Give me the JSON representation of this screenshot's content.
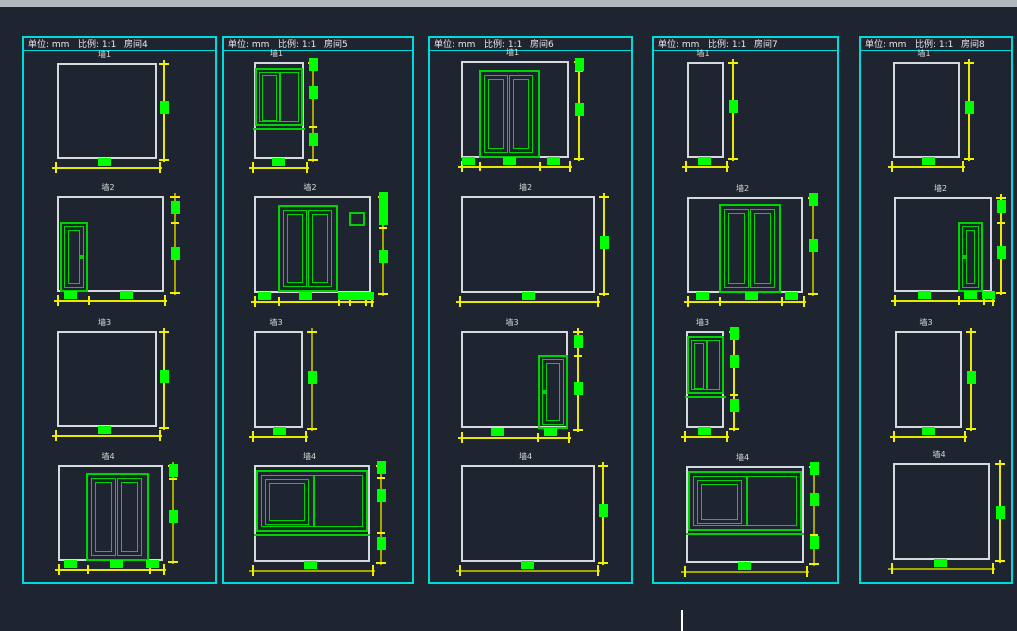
{
  "theme": {
    "background": "#1f2530",
    "titlebar_edge": "#b4b9c0",
    "panel_border": "#00dcdc",
    "wall_outline": "#d6dade",
    "feature_green": "#00d400",
    "dim_block_green": "#00ff00",
    "dim_bright": "#e9e900",
    "dim_dark": "#a6a600",
    "tick_yellow": "#f2f200",
    "text": "#e8e8e8",
    "cursor": "#ffffff"
  },
  "cursor": {
    "x": 681,
    "y": 610,
    "w": 2,
    "h": 21
  },
  "panels": [
    {
      "box": {
        "x": 22,
        "y": 36,
        "w": 195,
        "h": 548
      },
      "header": {
        "unit_label": "单位: mm",
        "scale_label": "比例: 1:1",
        "room_label": "房间4"
      },
      "walls": [
        {
          "label": "墙1",
          "rect": {
            "x": 57,
            "y": 63,
            "w": 100,
            "h": 96
          },
          "features": [],
          "vdim": {
            "x": 163,
            "y1": 63,
            "y2": 159,
            "ticks": [
              63,
              159
            ],
            "blocks": [
              107
            ],
            "tone": "b"
          },
          "hdim": {
            "y": 167,
            "x1": 55,
            "x2": 159,
            "ticks": [
              55,
              159
            ],
            "blocks": [
              104
            ],
            "tone": "b"
          }
        },
        {
          "label": "墙2",
          "rect": {
            "x": 57,
            "y": 196,
            "w": 107,
            "h": 96
          },
          "features": [
            {
              "type": "door",
              "x": 60,
              "y": 222,
              "w": 28,
              "h": 70,
              "handle": "right"
            }
          ],
          "vdim": {
            "x": 174,
            "y1": 196,
            "y2": 292,
            "ticks": [
              196,
              222,
              292
            ],
            "blocks": [
              207,
              253
            ],
            "tone": "d"
          },
          "hdim": {
            "y": 300,
            "x1": 57,
            "x2": 164,
            "ticks": [
              57,
              88,
              164
            ],
            "blocks": [
              70,
              126
            ],
            "tone": "b"
          }
        },
        {
          "label": "墙3",
          "rect": {
            "x": 57,
            "y": 331,
            "w": 100,
            "h": 96
          },
          "features": [],
          "vdim": {
            "x": 163,
            "y1": 331,
            "y2": 427,
            "ticks": [
              331,
              427
            ],
            "blocks": [
              376
            ],
            "tone": "b"
          },
          "hdim": {
            "y": 435,
            "x1": 55,
            "x2": 159,
            "ticks": [
              55,
              159
            ],
            "blocks": [
              104
            ],
            "tone": "b"
          }
        },
        {
          "label": "墙4",
          "rect": {
            "x": 58,
            "y": 465,
            "w": 105,
            "h": 96
          },
          "features": [
            {
              "type": "ddoor",
              "x": 86,
              "y": 473,
              "w": 63,
              "h": 88
            }
          ],
          "vdim": {
            "x": 172,
            "y1": 465,
            "y2": 561,
            "ticks": [
              465,
              478,
              561
            ],
            "blocks": [
              470,
              516
            ],
            "tone": "d"
          },
          "hdim": {
            "y": 569,
            "x1": 58,
            "x2": 163,
            "ticks": [
              58,
              87,
              149,
              163
            ],
            "blocks": [
              70,
              116,
              152
            ],
            "tone": "b"
          }
        }
      ]
    },
    {
      "box": {
        "x": 222,
        "y": 36,
        "w": 192,
        "h": 548
      },
      "header": {
        "unit_label": "单位: mm",
        "scale_label": "比例: 1:1",
        "room_label": "房间5"
      },
      "walls": [
        {
          "label": "墙1",
          "rect": {
            "x": 254,
            "y": 62,
            "w": 50,
            "h": 97
          },
          "features": [
            {
              "type": "window2",
              "x": 255,
              "y": 68,
              "w": 48,
              "h": 58
            }
          ],
          "vdim": {
            "x": 312,
            "y1": 62,
            "y2": 159,
            "ticks": [
              62,
              126,
              159
            ],
            "blocks": [
              64,
              92,
              139
            ],
            "tone": "d"
          },
          "hdim": {
            "y": 167,
            "x1": 252,
            "x2": 306,
            "ticks": [
              252,
              306
            ],
            "blocks": [
              278
            ],
            "tone": "b"
          }
        },
        {
          "label": "墙2",
          "rect": {
            "x": 254,
            "y": 196,
            "w": 117,
            "h": 97
          },
          "features": [
            {
              "type": "ddoor",
              "x": 278,
              "y": 205,
              "w": 60,
              "h": 87
            },
            {
              "type": "swin",
              "x": 349,
              "y": 212,
              "w": 16,
              "h": 14
            }
          ],
          "vdim": {
            "x": 382,
            "y1": 196,
            "y2": 293,
            "ticks": [
              196,
              211,
              227,
              293
            ],
            "blocks": [
              198,
              207,
              218,
              256
            ],
            "tone": "d"
          },
          "hdim": {
            "y": 301,
            "x1": 254,
            "x2": 371,
            "ticks": [
              254,
              278,
              338,
              349,
              365,
              371
            ],
            "blocks": [
              264,
              305,
              344,
              356,
              367
            ],
            "tone": "b"
          }
        },
        {
          "label": "墙3",
          "rect": {
            "x": 254,
            "y": 331,
            "w": 49,
            "h": 97
          },
          "features": [],
          "vdim": {
            "x": 311,
            "y1": 331,
            "y2": 428,
            "ticks": [
              331,
              428
            ],
            "blocks": [
              377
            ],
            "tone": "d"
          },
          "hdim": {
            "y": 436,
            "x1": 252,
            "x2": 305,
            "ticks": [
              252,
              305
            ],
            "blocks": [
              279
            ],
            "tone": "b"
          }
        },
        {
          "label": "墙4",
          "rect": {
            "x": 254,
            "y": 465,
            "w": 116,
            "h": 97
          },
          "features": [
            {
              "type": "windowW",
              "x": 256,
              "y": 470,
              "w": 112,
              "h": 62
            }
          ],
          "vdim": {
            "x": 380,
            "y1": 465,
            "y2": 562,
            "ticks": [
              465,
              477,
              532,
              562
            ],
            "blocks": [
              467,
              495,
              543
            ],
            "tone": "d"
          },
          "hdim": {
            "y": 570,
            "x1": 252,
            "x2": 372,
            "ticks": [
              252,
              372
            ],
            "blocks": [
              310
            ],
            "tone": "d"
          }
        }
      ]
    },
    {
      "box": {
        "x": 428,
        "y": 36,
        "w": 205,
        "h": 548
      },
      "header": {
        "unit_label": "单位: mm",
        "scale_label": "比例: 1:1",
        "room_label": "房间6"
      },
      "walls": [
        {
          "label": "墙1",
          "rect": {
            "x": 461,
            "y": 61,
            "w": 108,
            "h": 97
          },
          "features": [
            {
              "type": "ddoor",
              "x": 479,
              "y": 70,
              "w": 61,
              "h": 88
            }
          ],
          "vdim": {
            "x": 578,
            "y1": 61,
            "y2": 158,
            "ticks": [
              61,
              70,
              158
            ],
            "blocks": [
              64,
              109
            ],
            "tone": "b"
          },
          "hdim": {
            "y": 166,
            "x1": 461,
            "x2": 569,
            "ticks": [
              461,
              479,
              539,
              569
            ],
            "blocks": [
              468,
              509,
              553
            ],
            "tone": "b"
          }
        },
        {
          "label": "墙2",
          "rect": {
            "x": 461,
            "y": 196,
            "w": 134,
            "h": 97
          },
          "features": [],
          "vdim": {
            "x": 603,
            "y1": 196,
            "y2": 293,
            "ticks": [
              196,
              293
            ],
            "blocks": [
              242
            ],
            "tone": "b"
          },
          "hdim": {
            "y": 301,
            "x1": 459,
            "x2": 597,
            "ticks": [
              459,
              597
            ],
            "blocks": [
              528
            ],
            "tone": "b"
          }
        },
        {
          "label": "墙3",
          "rect": {
            "x": 461,
            "y": 331,
            "w": 107,
            "h": 97
          },
          "features": [
            {
              "type": "door",
              "x": 538,
              "y": 355,
              "w": 30,
              "h": 74,
              "handle": "left"
            }
          ],
          "vdim": {
            "x": 577,
            "y1": 331,
            "y2": 429,
            "ticks": [
              331,
              355,
              429
            ],
            "blocks": [
              341,
              388
            ],
            "tone": "b"
          },
          "hdim": {
            "y": 437,
            "x1": 461,
            "x2": 568,
            "ticks": [
              461,
              537,
              568
            ],
            "blocks": [
              497,
              550
            ],
            "tone": "b"
          }
        },
        {
          "label": "墙4",
          "rect": {
            "x": 461,
            "y": 465,
            "w": 134,
            "h": 97
          },
          "features": [],
          "vdim": {
            "x": 602,
            "y1": 465,
            "y2": 562,
            "ticks": [
              465,
              562
            ],
            "blocks": [
              510
            ],
            "tone": "b"
          },
          "hdim": {
            "y": 570,
            "x1": 459,
            "x2": 597,
            "ticks": [
              459,
              597
            ],
            "blocks": [
              527
            ],
            "tone": "d"
          }
        }
      ]
    },
    {
      "box": {
        "x": 652,
        "y": 36,
        "w": 187,
        "h": 548
      },
      "header": {
        "unit_label": "单位: mm",
        "scale_label": "比例: 1:1",
        "room_label": "房间7"
      },
      "walls": [
        {
          "label": "墙1",
          "rect": {
            "x": 687,
            "y": 62,
            "w": 37,
            "h": 96
          },
          "features": [],
          "vdim": {
            "x": 732,
            "y1": 62,
            "y2": 158,
            "ticks": [
              62,
              158
            ],
            "blocks": [
              106
            ],
            "tone": "b"
          },
          "hdim": {
            "y": 166,
            "x1": 685,
            "x2": 726,
            "ticks": [
              685,
              726
            ],
            "blocks": [
              704
            ],
            "tone": "b"
          }
        },
        {
          "label": "墙2",
          "rect": {
            "x": 687,
            "y": 197,
            "w": 116,
            "h": 96
          },
          "features": [
            {
              "type": "ddoor",
              "x": 719,
              "y": 204,
              "w": 62,
              "h": 89
            }
          ],
          "vdim": {
            "x": 812,
            "y1": 197,
            "y2": 293,
            "ticks": [
              197,
              204,
              293
            ],
            "blocks": [
              199,
              245
            ],
            "tone": "d"
          },
          "hdim": {
            "y": 301,
            "x1": 687,
            "x2": 803,
            "ticks": [
              687,
              719,
              781,
              803
            ],
            "blocks": [
              702,
              751,
              791
            ],
            "tone": "b"
          }
        },
        {
          "label": "墙3",
          "rect": {
            "x": 686,
            "y": 331,
            "w": 38,
            "h": 97
          },
          "features": [
            {
              "type": "window2",
              "x": 687,
              "y": 336,
              "w": 37,
              "h": 58
            }
          ],
          "vdim": {
            "x": 733,
            "y1": 331,
            "y2": 428,
            "ticks": [
              331,
              336,
              394,
              428
            ],
            "blocks": [
              333,
              361,
              405
            ],
            "tone": "b"
          },
          "hdim": {
            "y": 436,
            "x1": 684,
            "x2": 726,
            "ticks": [
              684,
              726
            ],
            "blocks": [
              704
            ],
            "tone": "b"
          }
        },
        {
          "label": "墙4",
          "rect": {
            "x": 686,
            "y": 466,
            "w": 118,
            "h": 97
          },
          "features": [
            {
              "type": "windowW",
              "x": 688,
              "y": 471,
              "w": 114,
              "h": 60
            }
          ],
          "vdim": {
            "x": 813,
            "y1": 466,
            "y2": 563,
            "ticks": [
              466,
              471,
              534,
              563
            ],
            "blocks": [
              468,
              499,
              542
            ],
            "tone": "d"
          },
          "hdim": {
            "y": 571,
            "x1": 684,
            "x2": 806,
            "ticks": [
              684,
              806
            ],
            "blocks": [
              744
            ],
            "tone": "d"
          }
        }
      ]
    },
    {
      "box": {
        "x": 859,
        "y": 36,
        "w": 154,
        "h": 548
      },
      "header": {
        "unit_label": "单位: mm",
        "scale_label": "比例: 1:1",
        "room_label": "房间8"
      },
      "walls": [
        {
          "label": "墙1",
          "rect": {
            "x": 893,
            "y": 62,
            "w": 67,
            "h": 96
          },
          "features": [],
          "vdim": {
            "x": 968,
            "y1": 62,
            "y2": 158,
            "ticks": [
              62,
              158
            ],
            "blocks": [
              107
            ],
            "tone": "b"
          },
          "hdim": {
            "y": 166,
            "x1": 891,
            "x2": 962,
            "ticks": [
              891,
              962
            ],
            "blocks": [
              928
            ],
            "tone": "b"
          }
        },
        {
          "label": "墙2",
          "rect": {
            "x": 894,
            "y": 197,
            "w": 98,
            "h": 95
          },
          "features": [
            {
              "type": "door",
              "x": 958,
              "y": 222,
              "w": 25,
              "h": 70,
              "handle": "left"
            }
          ],
          "vdim": {
            "x": 1000,
            "y1": 197,
            "y2": 292,
            "ticks": [
              197,
              222,
              292
            ],
            "blocks": [
              206,
              252
            ],
            "tone": "b"
          },
          "hdim": {
            "y": 300,
            "x1": 894,
            "x2": 992,
            "ticks": [
              894,
              958,
              983,
              992
            ],
            "blocks": [
              924,
              970,
              988
            ],
            "tone": "b"
          }
        },
        {
          "label": "墙3",
          "rect": {
            "x": 895,
            "y": 331,
            "w": 67,
            "h": 97
          },
          "features": [],
          "vdim": {
            "x": 970,
            "y1": 331,
            "y2": 428,
            "ticks": [
              331,
              428
            ],
            "blocks": [
              377
            ],
            "tone": "b"
          },
          "hdim": {
            "y": 436,
            "x1": 893,
            "x2": 964,
            "ticks": [
              893,
              964
            ],
            "blocks": [
              928
            ],
            "tone": "b"
          }
        },
        {
          "label": "墙4",
          "rect": {
            "x": 893,
            "y": 463,
            "w": 97,
            "h": 97
          },
          "features": [],
          "vdim": {
            "x": 999,
            "y1": 463,
            "y2": 560,
            "ticks": [
              463,
              560
            ],
            "blocks": [
              512
            ],
            "tone": "b"
          },
          "hdim": {
            "y": 568,
            "x1": 891,
            "x2": 992,
            "ticks": [
              891,
              992
            ],
            "blocks": [
              940
            ],
            "tone": "d"
          }
        }
      ]
    }
  ]
}
